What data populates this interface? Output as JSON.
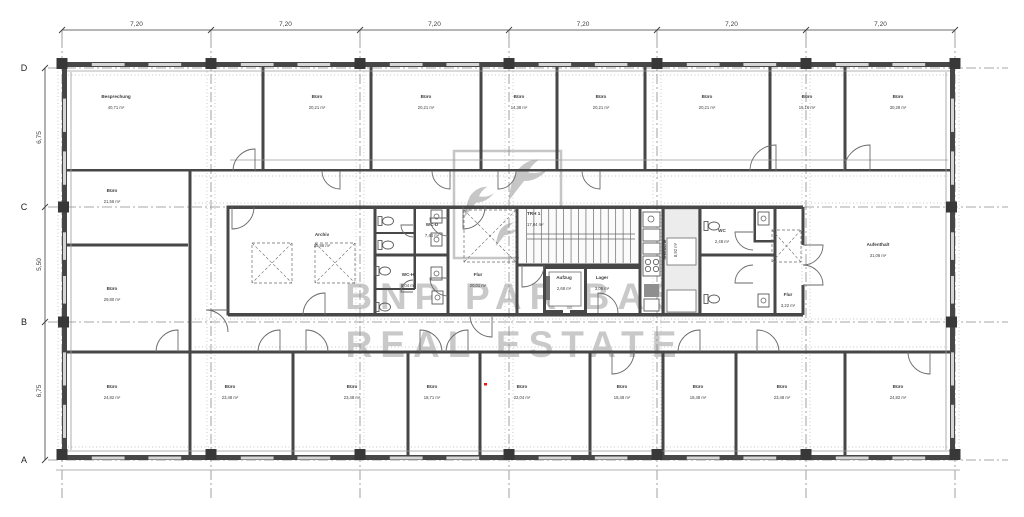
{
  "document": {
    "type": "architectural-floor-plan",
    "watermark": {
      "line1": "BNP PARIBAS",
      "line2": "REAL ESTATE",
      "color": "#c9c9c9"
    }
  },
  "axes": {
    "cols": [
      62,
      211,
      360,
      509,
      657,
      806,
      955
    ],
    "rows": [
      68,
      207,
      322,
      460
    ],
    "row_labels": [
      "D",
      "C",
      "B",
      "A"
    ],
    "col_dims": [
      "7,20",
      "7,20",
      "7,20",
      "7,20",
      "7,20",
      "7,20"
    ],
    "row_dims": [
      "6,75",
      "5,50",
      "6,75"
    ]
  },
  "colors": {
    "wall": "#474747",
    "column": "#383838",
    "thin": "#6a6a6a",
    "fixture": "#5a5a5a",
    "dotted": "#b5b5b5",
    "axis": "#8a8a8a",
    "dim": "#3c3c3c",
    "label": "#3d3d3d",
    "light": "#ececec",
    "window": "#d6d6d6",
    "watermark": "#c9c9c9",
    "logo": "#c6c6c6",
    "red": "#cc2222",
    "appliance": "#8f8f8f"
  },
  "rooms": [
    {
      "n": "Besprechung",
      "a": "40,71 m²",
      "x": 116,
      "y": 98
    },
    {
      "n": "Büro",
      "a": "20,21 m²",
      "x": 317,
      "y": 98
    },
    {
      "n": "Büro",
      "a": "20,21 m²",
      "x": 426,
      "y": 98
    },
    {
      "n": "Büro",
      "a": "14,38 m²",
      "x": 519,
      "y": 98
    },
    {
      "n": "Büro",
      "a": "20,21 m²",
      "x": 601,
      "y": 98
    },
    {
      "n": "Büro",
      "a": "20,21 m²",
      "x": 707,
      "y": 98
    },
    {
      "n": "Büro",
      "a": "15,16 m²",
      "x": 807,
      "y": 98
    },
    {
      "n": "Büro",
      "a": "30,28 m²",
      "x": 898,
      "y": 98
    },
    {
      "n": "Büro",
      "a": "21,56 m²",
      "x": 112,
      "y": 192
    },
    {
      "n": "Büro",
      "a": "29,80 m²",
      "x": 112,
      "y": 290
    },
    {
      "n": "Archiv",
      "a": "35,86 m²",
      "x": 322,
      "y": 236
    },
    {
      "n": "WC-D",
      "a": "7,44 m²",
      "x": 432,
      "y": 226
    },
    {
      "n": "WC-H",
      "a": "8,04 m²",
      "x": 408,
      "y": 276
    },
    {
      "n": "Flur",
      "a": "20,01 m²",
      "x": 478,
      "y": 276
    },
    {
      "n": "TRH 1",
      "a": "17,04 m²",
      "x": 527,
      "y": 215,
      "anc": "start"
    },
    {
      "n": "Aufzug",
      "a": "2,68 m²",
      "x": 564,
      "y": 279
    },
    {
      "n": "Lager",
      "a": "3,08 m²",
      "x": 602,
      "y": 279
    },
    {
      "n": "Teeküche",
      "a": "8,92 m²",
      "x": 666,
      "y": 250,
      "rot": -90
    },
    {
      "n": "WC",
      "a": "2,48 m²",
      "x": 722,
      "y": 232
    },
    {
      "n": "Flur",
      "a": "3,22 m²",
      "x": 788,
      "y": 296
    },
    {
      "n": "Aufenthalt",
      "a": "31,06 m²",
      "x": 878,
      "y": 246
    },
    {
      "n": "Büro",
      "a": "24,82 m²",
      "x": 112,
      "y": 388
    },
    {
      "n": "Büro",
      "a": "23,48 m²",
      "x": 230,
      "y": 388
    },
    {
      "n": "Büro",
      "a": "23,48 m²",
      "x": 352,
      "y": 388
    },
    {
      "n": "Büro",
      "a": "18,71 m²",
      "x": 432,
      "y": 388
    },
    {
      "n": "Büro",
      "a": "22,04 m²",
      "x": 522,
      "y": 388
    },
    {
      "n": "Büro",
      "a": "18,48 m²",
      "x": 622,
      "y": 388
    },
    {
      "n": "Büro",
      "a": "18,48 m²",
      "x": 698,
      "y": 388
    },
    {
      "n": "Büro",
      "a": "23,48 m²",
      "x": 782,
      "y": 388
    },
    {
      "n": "Büro",
      "a": "24,82 m²",
      "x": 898,
      "y": 388
    }
  ],
  "geometry": {
    "building": {
      "x": 62,
      "y": 62,
      "w": 893,
      "h": 398
    },
    "walls": [
      [
        62,
        62,
        893,
        5
      ],
      [
        62,
        455,
        893,
        5
      ],
      [
        62,
        62,
        5,
        398
      ],
      [
        950,
        62,
        5,
        398
      ],
      [
        261.5,
        67,
        3,
        104
      ],
      [
        369.5,
        67,
        3,
        104
      ],
      [
        479.5,
        67,
        3,
        104
      ],
      [
        555.5,
        67,
        3,
        104
      ],
      [
        643.5,
        67,
        3,
        104
      ],
      [
        768.5,
        67,
        3,
        104
      ],
      [
        843.5,
        67,
        3,
        104
      ],
      [
        67,
        169,
        888,
        2.5
      ],
      [
        188.5,
        171,
        3,
        284
      ],
      [
        67,
        243.5,
        121,
        3
      ],
      [
        226.5,
        205.5,
        3,
        110
      ],
      [
        228,
        205.5,
        575,
        3.5
      ],
      [
        228,
        313,
        575,
        3.5
      ],
      [
        373.5,
        207,
        3,
        108
      ],
      [
        446.5,
        207,
        3,
        108
      ],
      [
        515.5,
        207,
        3,
        108
      ],
      [
        517,
        263.5,
        123,
        3
      ],
      [
        638.5,
        207,
        3,
        108
      ],
      [
        375,
        253.5,
        73,
        3
      ],
      [
        413.5,
        207,
        2.5,
        48
      ],
      [
        375,
        232,
        40,
        2
      ],
      [
        413.5,
        255,
        2.5,
        34
      ],
      [
        375,
        288,
        40,
        2
      ],
      [
        543,
        266,
        98,
        3
      ],
      [
        543,
        266,
        3,
        47
      ],
      [
        584,
        266,
        3,
        47
      ],
      [
        543,
        310,
        20,
        3
      ],
      [
        570,
        310,
        17,
        3
      ],
      [
        661.5,
        207,
        3,
        108
      ],
      [
        698.5,
        207,
        3,
        108
      ],
      [
        773.5,
        207,
        3,
        108
      ],
      [
        700,
        253.5,
        75,
        3
      ],
      [
        753.5,
        207,
        2.5,
        35
      ],
      [
        753.5,
        240,
        21.5,
        2.5
      ],
      [
        801.5,
        207,
        3,
        38
      ],
      [
        801.5,
        285,
        3,
        30
      ],
      [
        67,
        350.5,
        888,
        3
      ],
      [
        291.5,
        353.5,
        3,
        101.5
      ],
      [
        406.5,
        353.5,
        3,
        101.5
      ],
      [
        478.5,
        353.5,
        3,
        101.5
      ],
      [
        588.5,
        353.5,
        3,
        101.5
      ],
      [
        661.5,
        353.5,
        3,
        101.5
      ],
      [
        734.5,
        353.5,
        3,
        101.5
      ],
      [
        843.5,
        353.5,
        3,
        101.5
      ]
    ],
    "light_rects": [
      [
        664.5,
        209,
        34,
        104
      ]
    ],
    "white_boxes": [
      [
        667,
        238,
        29,
        27
      ],
      [
        667,
        290,
        29,
        22
      ],
      [
        549,
        272,
        32,
        34
      ]
    ],
    "thin_lines": [
      [
        67,
        71,
        950,
        71
      ],
      [
        67,
        451,
        950,
        451
      ],
      [
        71,
        72,
        71,
        450
      ],
      [
        946,
        72,
        946,
        450
      ],
      [
        230,
        160,
        948,
        160
      ],
      [
        56,
        470,
        960,
        470
      ]
    ],
    "shafts": [
      [
        252,
        243,
        40,
        40
      ],
      [
        315,
        243,
        40,
        40
      ],
      [
        464,
        210,
        52,
        52
      ],
      [
        772,
        230,
        29,
        32
      ]
    ],
    "stair": {
      "x": 519,
      "y": 209,
      "w": 119,
      "h": 54,
      "treads": 15,
      "rail1": 234,
      "rail2": 239
    },
    "rail_rect": [
      546,
      276,
      4,
      24
    ],
    "doors": [
      "M255,171 L255,149 A22,22 0 0 0 233,171",
      "M340,171 L340,189 A18,18 0 0 1 322,171",
      "M450,171 L450,189 A18,18 0 0 1 432,171",
      "M498,171 L498,189 A18,18 0 0 0 516,171",
      "M600,171 L600,189 A18,18 0 0 1 582,171",
      "M776,171 L776,145 A26,26 0 0 0 750,171",
      "M870,171 L870,145 A26,26 0 0 0 844,171",
      "M232,207 L232,229 A22,22 0 0 0 254,207",
      "M325,315 L325,293 A22,22 0 0 0 303,315",
      "M228,310 L206,310 A22,22 0 0 1 228,332",
      "M448,218 L430,218 A18,18 0 0 0 448,236",
      "M448,278 L430,278 A18,18 0 0 0 448,296",
      "M413,225 L401,225 A12,12 0 0 0 413,237",
      "M413,292 L401,292 A12,12 0 0 1 413,280",
      "M463,207 L463,229 A22,22 0 0 0 485,207",
      "M492,315 L492,337 A22,22 0 0 1 470,315",
      "M522,265 L522,287 A22,22 0 0 0 544,265",
      "M598,313 L598,293 A20,20 0 0 1 618,313",
      "M753,232 L735,232 A18,18 0 0 0 753,250",
      "M753,283 L735,283 A18,18 0 0 1 753,265",
      "M803,245 L823,245 A20,20 0 0 1 803,265",
      "M803,285 L823,285 A20,20 0 0 0 803,265",
      "M178,352 L178,330 A22,22 0 0 0 156,352",
      "M280,352 L280,330 A22,22 0 0 0 258,352",
      "M306,352 L306,330 A22,22 0 0 1 328,352",
      "M420,352 L420,330 A22,22 0 0 1 442,352",
      "M468,352 L468,330 A22,22 0 0 0 446,352",
      "M612,352 L612,374 A22,22 0 0 0 634,352",
      "M700,352 L700,330 A22,22 0 0 0 678,352",
      "M757,352 L757,330 A22,22 0 0 1 779,352",
      "M930,352 L930,374 A22,22 0 0 1 908,352"
    ],
    "toilets": [
      [
        388,
        221
      ],
      [
        388,
        245
      ],
      [
        385,
        271
      ],
      [
        385,
        307
      ],
      [
        714,
        226
      ],
      [
        714,
        299
      ]
    ],
    "sinks": [
      [
        431,
        210
      ],
      [
        431,
        233
      ],
      [
        431,
        267
      ],
      [
        432,
        291
      ],
      [
        758,
        212
      ],
      [
        758,
        294
      ]
    ],
    "kitchen": {
      "boxes": [
        [
          643,
          212,
          17,
          15
        ],
        [
          643,
          229,
          17,
          12
        ],
        [
          643,
          243,
          17,
          11
        ],
        [
          643,
          256,
          17,
          20
        ],
        [
          644,
          299,
          15,
          12
        ]
      ],
      "sink_circle": [
        651,
        219,
        3
      ],
      "stove": [
        [
          648,
          262
        ],
        [
          656,
          262
        ],
        [
          648,
          269
        ],
        [
          656,
          269
        ]
      ],
      "stove_r": 2.7,
      "dark_box": [
        644,
        284,
        15,
        13
      ]
    },
    "corridor_dotted_y": [
      176,
      203,
      319,
      347
    ],
    "facade_dotted_y": [
      75,
      447
    ],
    "red_mark": [
      484,
      383,
      3,
      2.5
    ],
    "logo": {
      "square": [
        454,
        151,
        107,
        107
      ],
      "swallows": [
        [
          516,
          172,
          1.5
        ],
        [
          470,
          196,
          1.1
        ],
        [
          500,
          230,
          0.85
        ]
      ]
    },
    "wm": {
      "x": 515,
      "y1": 309,
      "y2": 357,
      "size": 37,
      "spacing": 8
    }
  }
}
